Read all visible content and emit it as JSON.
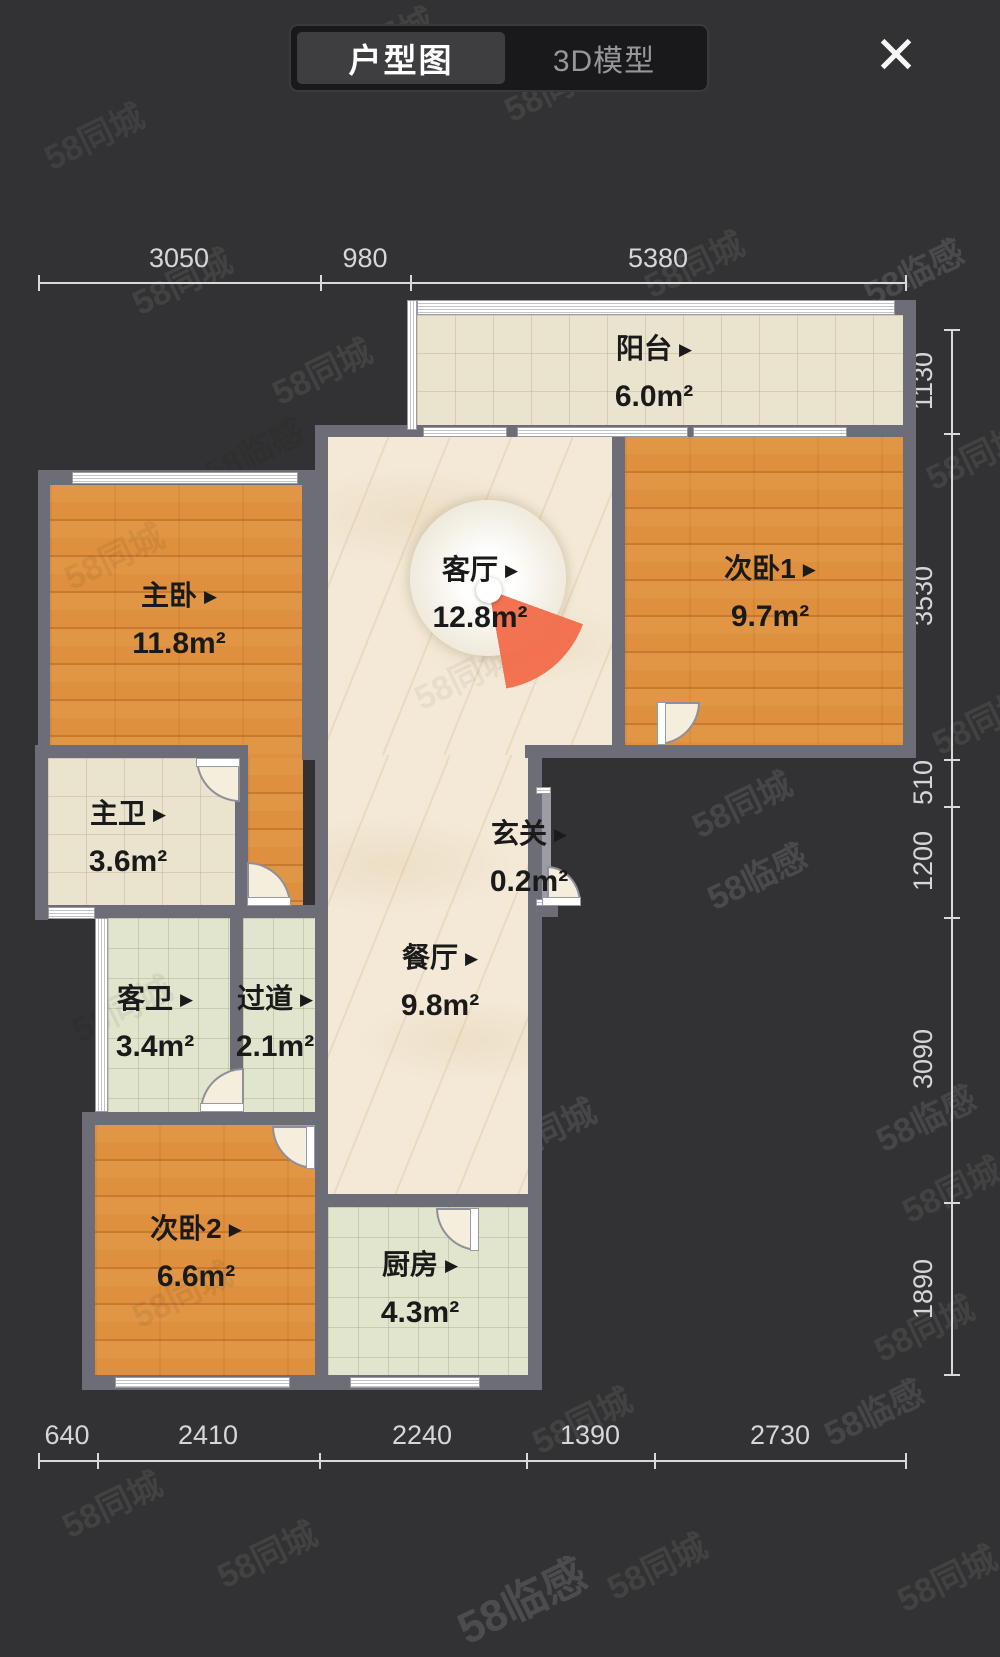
{
  "header": {
    "tabs": [
      {
        "label": "户型图",
        "active": true
      },
      {
        "label": "3D模型",
        "active": false
      }
    ],
    "close_icon": "✕"
  },
  "floorplan": {
    "label_arrow": "▶",
    "rooms": [
      {
        "id": "balcony",
        "name": "阳台",
        "area": "6.0m²"
      },
      {
        "id": "master-bedroom",
        "name": "主卧",
        "area": "11.8m²"
      },
      {
        "id": "living-room",
        "name": "客厅",
        "area": "12.8m²"
      },
      {
        "id": "bedroom-1",
        "name": "次卧1",
        "area": "9.7m²"
      },
      {
        "id": "master-bathroom",
        "name": "主卫",
        "area": "3.6m²"
      },
      {
        "id": "entryway",
        "name": "玄关",
        "area": "0.2m²"
      },
      {
        "id": "dining-room",
        "name": "餐厅",
        "area": "9.8m²"
      },
      {
        "id": "guest-bathroom",
        "name": "客卫",
        "area": "3.4m²"
      },
      {
        "id": "hallway",
        "name": "过道",
        "area": "2.1m²"
      },
      {
        "id": "bedroom-2",
        "name": "次卧2",
        "area": "6.6m²"
      },
      {
        "id": "kitchen",
        "name": "厨房",
        "area": "4.3m²"
      }
    ],
    "dimensions": {
      "top": [
        "3050",
        "980",
        "5380"
      ],
      "right": [
        "1130",
        "3530",
        "510",
        "1200",
        "3090",
        "1890"
      ],
      "bottom": [
        "640",
        "2410",
        "2240",
        "1390",
        "2730"
      ]
    }
  },
  "watermarks": {
    "brand": "58同城",
    "brand2": "58临感"
  },
  "colors": {
    "background": "#323234",
    "wall": "#6d6d77",
    "wood_floor": "#de903e",
    "marble_floor": "#f3e9d6",
    "tile_beige": "#eae4cf",
    "tile_green": "#e2e5cd",
    "compass_slice": "#f26c4a",
    "label_text": "#1a1a1a",
    "dimension_text": "#d6d6da"
  }
}
